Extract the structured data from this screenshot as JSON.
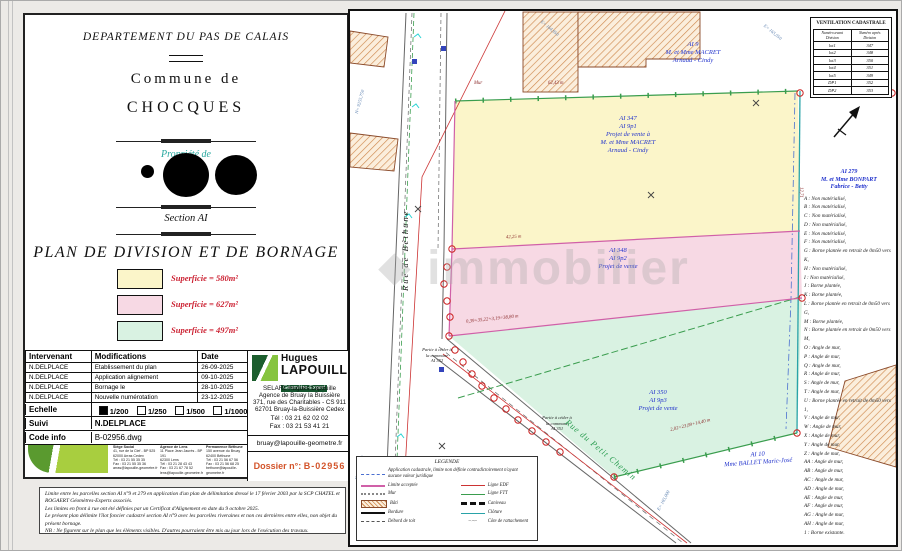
{
  "watermarks": {
    "top_left": "© EtreProprio",
    "center": "immobilier"
  },
  "title_block": {
    "department": "DEPARTEMENT DU PAS DE CALAIS",
    "commune_label": "Commune de",
    "commune_name": "CHOCQUES",
    "property_label": "Propriété de",
    "section": "Section AI",
    "main_title": "PLAN DE DIVISION ET DE BORNAGE",
    "areas": [
      {
        "color": "#fbf5c9",
        "label": "Superficie = 580m²"
      },
      {
        "color": "#f7d9e4",
        "label": "Superficie = 627m²"
      },
      {
        "color": "#d9f2e2",
        "label": "Superficie = 497m²"
      }
    ]
  },
  "revisions": {
    "headers": [
      "Intervenant",
      "Modifications",
      "Date"
    ],
    "rows": [
      [
        "N.DELPLACE",
        "Etablissement du plan",
        "26-09-2025"
      ],
      [
        "N.DELPLACE",
        "Application alignement",
        "09-10-2025"
      ],
      [
        "N.DELPLACE",
        "Bornage le",
        "28-10-2025"
      ],
      [
        "N.DELPLACE",
        "Nouvelle numérotation",
        "23-12-2025"
      ]
    ],
    "echelle_label": "Echelle",
    "scales": [
      {
        "label": "1/200",
        "checked": true
      },
      {
        "label": "1/250",
        "checked": false
      },
      {
        "label": "1/500",
        "checked": false
      },
      {
        "label": "1/1000",
        "checked": false
      },
      {
        "label": "1/2000",
        "checked": false
      }
    ],
    "suivi_label": "Suivi",
    "suivi_value": "N.DELPLACE",
    "code_label": "Code info",
    "code_value": "B-02956.dwg"
  },
  "firm": {
    "name_top": "Hugues",
    "name_bottom": "LAPOUILLE",
    "subtitle": "Géomètre-Expert",
    "address": [
      "SELARL Hugues Lapouille",
      "Agence de Bruay la Buissière",
      "371, rue des Charitables - CS 911",
      "62701 Bruay-la-Buissière Cedex"
    ],
    "tel": "Tél : 03 21 62 02 02",
    "fax": "Fax : 03 21 53 41 21",
    "email": "bruay@lapouille-geometre.fr",
    "dossier_label": "Dossier n°:",
    "dossier_value": "B-02956",
    "offices": [
      {
        "lines": [
          "Siège Social",
          "41, rue de la Clef - BP 525",
          "62000 Arras Cedex",
          "Tél : 03 21 55 35 35",
          "Fax : 03 21 55 35 36",
          "arras@lapouille-geometre.fr"
        ]
      },
      {
        "lines": [
          "Agence de Lens",
          "11 Place Jean Jaurès - BP 191",
          "62300 Lens",
          "Tél : 03 21 28 43 43",
          "Fax : 03 21 67 78 52",
          "lens@lapouille-geometre.fr"
        ]
      },
      {
        "lines": [
          "Permanence Béthune",
          "150 avenue du Bruay",
          "62400 Béthune",
          "Tél : 03 21 56 67 56",
          "Fax : 03 21 56 68 25",
          "bethune@lapouille-geometre.fr"
        ]
      }
    ]
  },
  "notes": [
    "Limite entre les parcelles section AI n°9 et 279 en application d'un plan de délimitation dressé le 17 février 2003 par la SCP CHATEL et ROGAERT Géomètres-Experts associés.",
    "Les limites en front à rue ont été définies par un Certificat d'Alignement en date du 9 octobre 2025.",
    "Le présent plan délimite l'îlot foncier cadastré section AI n°9 avec les parcelles riveraines et non ces dernières entre elles, non objet du présent bornage.",
    "NB : Ne figurent sur le plan que les éléments visibles. D'autres pourraient être mis au jour lors de l'exécution des travaux."
  ],
  "map": {
    "ventilation": {
      "title": "VENTILATION CADASTRALE",
      "col_before": "Numéro avant Division",
      "col_after": "Numéro après Division",
      "rows": [
        [
          "lot1",
          "347"
        ],
        [
          "lot2",
          "348"
        ],
        [
          "lot3",
          "350"
        ],
        [
          "lot4",
          "351"
        ],
        [
          "lot5",
          "349"
        ],
        [
          "DP1",
          "352"
        ],
        [
          "DP2",
          "353"
        ]
      ]
    },
    "parcel_yellow": [
      "AI 347",
      "AI 9p1",
      "Projet de vente à",
      "M. et Mme MACRET",
      "Arnaud - Cindy"
    ],
    "parcel_pink": [
      "AI 348",
      "AI 9p2",
      "Projet de vente"
    ],
    "parcel_green": [
      "AI 350",
      "AI 9p3",
      "Projet de vente"
    ],
    "neighbor_north": [
      "AI 9",
      "M. et Mme MACRET",
      "Arnaud - Cindy"
    ],
    "neighbor_south": [
      "AI 10",
      "Mme BALLET Marie-José"
    ],
    "cession_west": [
      "Partie à céder à",
      "la commune",
      "AI 352"
    ],
    "cession_south": [
      "Partie à céder à",
      "la commune",
      "AI 351"
    ],
    "road_west": "Rue de Béthune",
    "road_south": "Rue du Petit Chemin",
    "dim_mur": "Mur",
    "dim_top": "62,43 m",
    "dim_yellow_pink": "42,25 m",
    "dim_pink_green": "0,39+35,22+3,19=38,80 m",
    "dim_south": "2,02+23,89+14,40 m",
    "dim_right": "12,71",
    "coords": [
      "N= 9255,750",
      "E= 164,950",
      "N= 9255,500",
      "E= 165,000",
      "E= 165,050"
    ],
    "bornes_header": [
      "AI 279",
      "M. et Mme BONPART",
      "Fabrice - Betty"
    ],
    "bornes_items": [
      "A : Non matérialisé,",
      "B : Non matérialisé,",
      "C : Non matérialisé,",
      "D : Non matérialisé,",
      "E : Non matérialisé,",
      "F : Non matérialisé,",
      "G : Borne plantée en retrait de 0m50 vers K,",
      "H : Non matérialisé,",
      "I : Non matérialisé,",
      "J : Borne plantée,",
      "K : Borne plantée,",
      "L : Borne plantée en retrait de 0m50 vers G,",
      "M : Borne plantée,",
      "N : Borne plantée en retrait de 0m50 vers M,",
      "O : Angle de mur,",
      "P : Angle de mur,",
      "Q : Angle de mur,",
      "R : Angle de mur,",
      "S : Angle de mur,",
      "T : Angle de mur,",
      "U : Borne plantée en retrait de 0m50 vers 1,",
      "V : Angle de mur,",
      "W : Angle de mur,",
      "X : Angle de mur,",
      "Y : Angle de mur,",
      "Z : Angle de mur,",
      "AA : Angle de mur,",
      "AB : Angle de mur,",
      "AC : Angle de mur,",
      "AD : Angle de mur,",
      "AE : Angle de mur,",
      "AF : Angle de mur,",
      "AG : Angle de mur,",
      "AH : Angle de mur,",
      "1 : Borne existante."
    ],
    "legend": {
      "title": "LEGENDE",
      "cadastre": "Application cadastrale, limite non définie contradictoirement n'ayant aucune valeur juridique",
      "limite": "Limite acceptée",
      "edf": "Ligne EDF",
      "mur": "Mur",
      "ftt": "Ligne FTT",
      "bati": "Bâti",
      "caniveau": "Caniveau",
      "bordure": "Bordure",
      "cloture": "Clôture",
      "debord": "Débord de toit",
      "rattachement": "Côte de rattachement"
    }
  }
}
